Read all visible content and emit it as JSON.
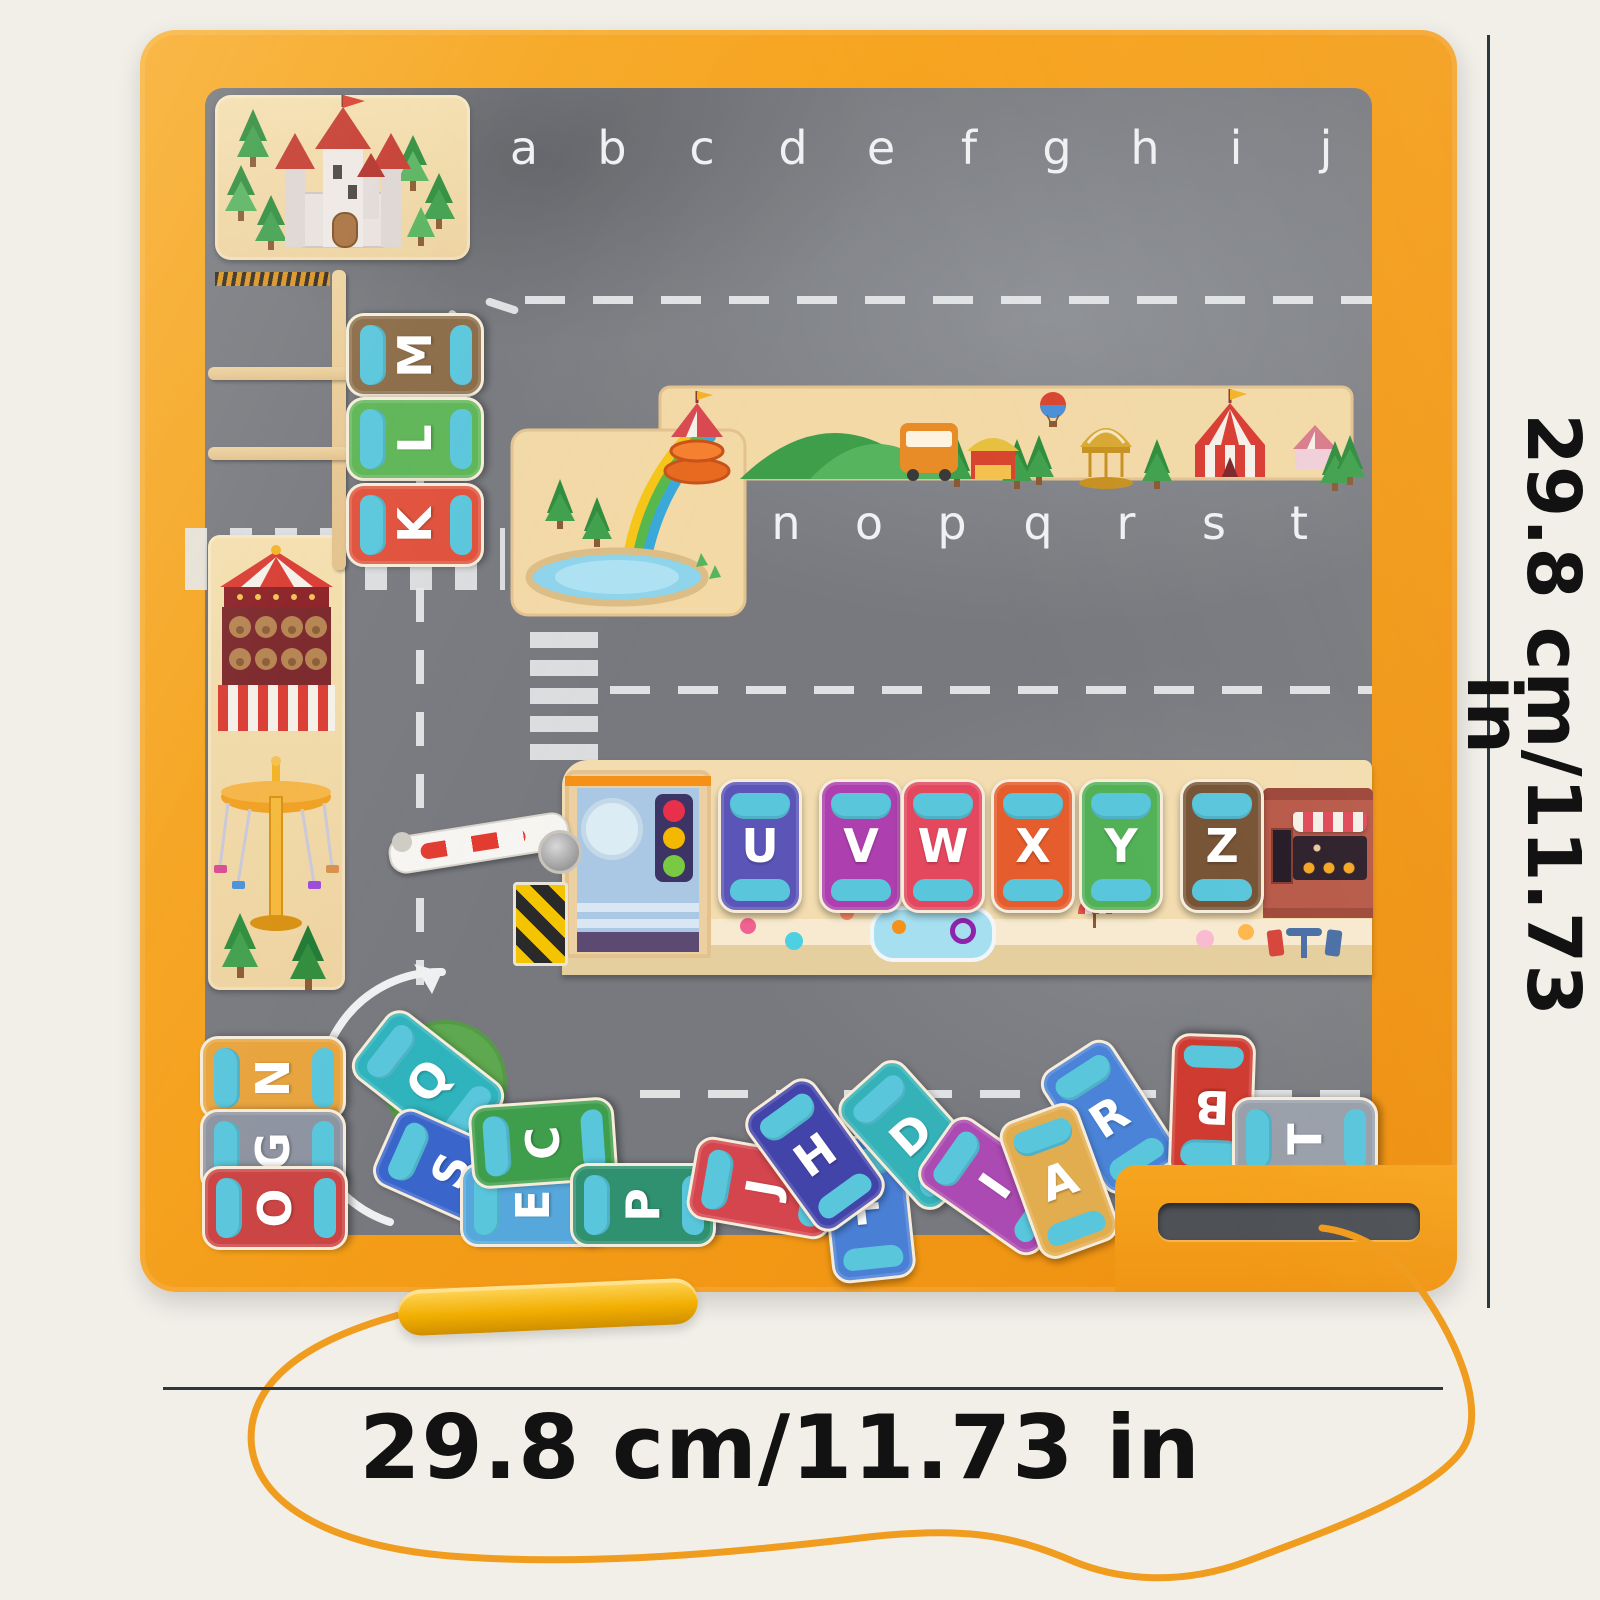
{
  "product": {
    "kind_label": "magnetic alphabet parking maze board",
    "accent_color": "#f5a01a",
    "surface_color": "#77797e",
    "pin_color": "#2ecc71",
    "pen_color": "#f2ae00",
    "string_color": "#f09d1f"
  },
  "dimensions": {
    "height_label": "29.8 cm/11.73 in",
    "width_label": "29.8 cm/11.73 in"
  },
  "board": {
    "top_slots": [
      "a",
      "b",
      "c",
      "d",
      "e",
      "f",
      "g",
      "h",
      "i",
      "j"
    ],
    "mid_slots": [
      "n",
      "o",
      "p",
      "q",
      "r",
      "s",
      "t"
    ],
    "parked_left": [
      {
        "letter": "M",
        "color": "#8a6a45"
      },
      {
        "letter": "L",
        "color": "#5cb554"
      },
      {
        "letter": "K",
        "color": "#e0503a"
      }
    ],
    "parked_mid": [
      {
        "letter": "U",
        "color": "#5b55b8"
      },
      {
        "letter": "V",
        "color": "#ad3fae"
      },
      {
        "letter": "W",
        "color": "#e4485e"
      },
      {
        "letter": "X",
        "color": "#e55c2d"
      },
      {
        "letter": "Y",
        "color": "#52b156"
      },
      {
        "letter": "Z",
        "color": "#775334"
      }
    ],
    "loose_cars": [
      {
        "letter": "N",
        "color": "#e8a33c"
      },
      {
        "letter": "G",
        "color": "#8d93a0"
      },
      {
        "letter": "O",
        "color": "#cc4343"
      },
      {
        "letter": "Q",
        "color": "#2fb3bc"
      },
      {
        "letter": "S",
        "color": "#3a66cc"
      },
      {
        "letter": "E",
        "color": "#56a8dc"
      },
      {
        "letter": "C",
        "color": "#3f9e4b"
      },
      {
        "letter": "P",
        "color": "#2f9170"
      },
      {
        "letter": "J",
        "color": "#d4454d"
      },
      {
        "letter": "F",
        "color": "#4a7fd6"
      },
      {
        "letter": "D",
        "color": "#35b2b8"
      },
      {
        "letter": "H",
        "color": "#4344aa"
      },
      {
        "letter": "I",
        "color": "#ab4ab2"
      },
      {
        "letter": "R",
        "color": "#4a83d8"
      },
      {
        "letter": "A",
        "color": "#e2ad4e"
      },
      {
        "letter": "B",
        "color": "#cf3b31"
      },
      {
        "letter": "T",
        "color": "#99a0aa"
      }
    ]
  }
}
